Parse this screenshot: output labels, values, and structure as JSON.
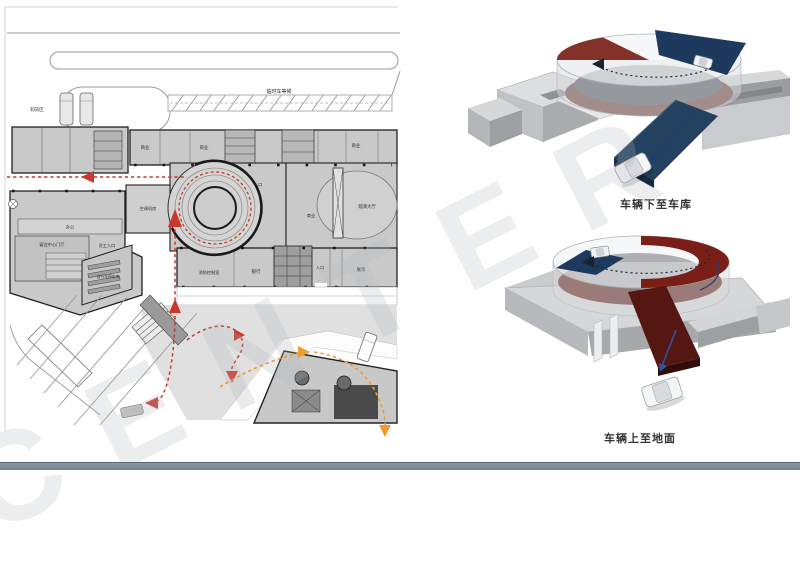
{
  "watermark": {
    "text": "CENTER"
  },
  "floor_plan": {
    "labels": {
      "temp_waiting": "临时车等候",
      "unloading_area": "卸货区",
      "shop": "商业",
      "office": "办公",
      "banquet_lobby": "宴会中心门厅",
      "staff_entrance": "员工入口",
      "bicycle_parking": "自行车停车库",
      "hvac_room": "空调机房",
      "freight_entrance": "货运入口",
      "theater_hall": "观演大厅",
      "fire_control_room": "消防控制室",
      "bank": "银行",
      "entrance": "入口",
      "exhibition": "展示"
    }
  },
  "renders": {
    "down_to_garage": {
      "caption": "车辆下至车库"
    },
    "up_to_ground": {
      "caption": "车辆上至地面"
    }
  },
  "colors": {
    "route_red": "#c9392b",
    "route_orange": "#f29a2e",
    "ramp_navy": "#1d3a5e",
    "ramp_dark_red": "#7a1f17",
    "arrow_blue": "#2b55a8",
    "bottom_bar": "#75818d"
  }
}
